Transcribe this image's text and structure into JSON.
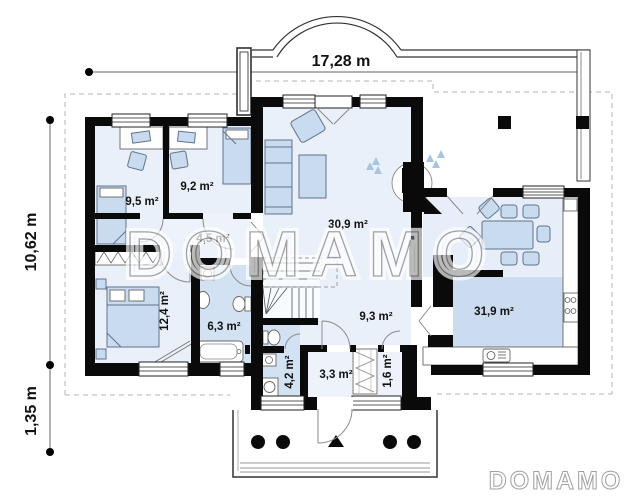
{
  "plan": {
    "dimensions": {
      "top_width": "17,28 m",
      "left_height": "10,62 m",
      "left_offset": "1,35 m"
    },
    "rooms": {
      "bedroom_1": {
        "area": "9,5 m²"
      },
      "bedroom_2": {
        "area": "9,2 m²"
      },
      "corridor": {
        "area": "4,5 m²"
      },
      "living_room": {
        "area": "30,9 m²"
      },
      "bedroom_3": {
        "area": "12,4 m²"
      },
      "bathroom": {
        "area": "6,3 m²"
      },
      "hall": {
        "area": "9,3 m²"
      },
      "kitchen_dining": {
        "area": "31,9 m²"
      },
      "wc": {
        "area": "4,2 m²"
      },
      "entry_hall": {
        "area": "3,3 m²"
      },
      "closet": {
        "area": "1,6 m²"
      }
    },
    "branding": {
      "watermark_center": "DOMAMO",
      "logo_bottom_right": "DOMAMO"
    },
    "colors": {
      "wall": "#0a0a0a",
      "room": "#eaf0f9",
      "wet_room": "#d3e2f3",
      "kitchen": "#cbdcf0",
      "dining": "#e7eef9",
      "furniture": "#c9dbee",
      "watermark": "#8f8f8f"
    }
  }
}
